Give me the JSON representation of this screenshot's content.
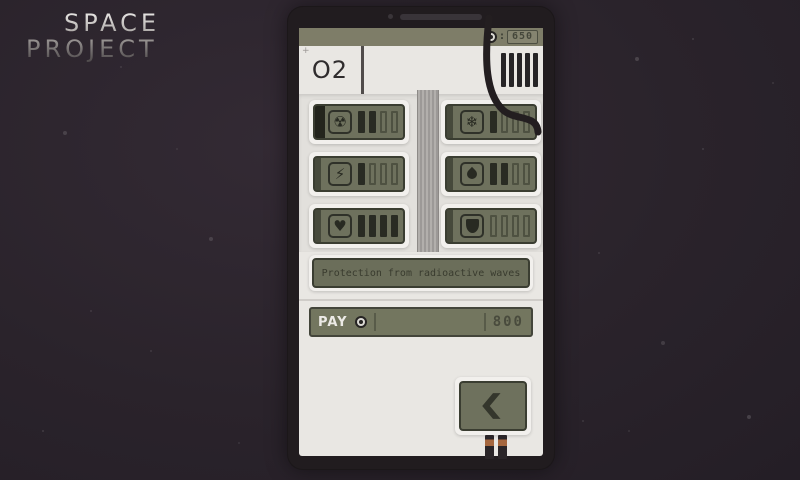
{
  "logo": {
    "line1": "SPACE",
    "line2": "PROJECT"
  },
  "palette": {
    "background": "#2a232b",
    "device_frame": "#211c1f",
    "screen": "#e9e7e3",
    "olive_panel": "#6e715d",
    "panel_border": "#3a3d31",
    "dark_ink": "#292b23",
    "copper_pin": "#a5673f"
  },
  "device": {
    "header": {
      "currency_icon": "gear-coin-icon",
      "separator": ":",
      "currency": "650"
    },
    "o2": {
      "plus": "+",
      "label": "O2",
      "gauge_bars": 5
    },
    "slots": [
      {
        "icon": "radiation-icon",
        "glyph": "☢",
        "bars_filled": 2,
        "bars_total": 4,
        "selected": true
      },
      {
        "icon": "snowflake-icon",
        "glyph": "❄",
        "bars_filled": 1,
        "bars_total": 4,
        "selected": false
      },
      {
        "icon": "lightning-icon",
        "glyph": "⚡",
        "bars_filled": 1,
        "bars_total": 4,
        "selected": false
      },
      {
        "icon": "flame-icon",
        "glyph": "",
        "shape": "flame",
        "bars_filled": 2,
        "bars_total": 4,
        "selected": false
      },
      {
        "icon": "heart-icon",
        "glyph": "♥",
        "bars_filled": 4,
        "bars_total": 4,
        "selected": false
      },
      {
        "icon": "shield-icon",
        "glyph": "",
        "shape": "shield",
        "bars_filled": 0,
        "bars_total": 4,
        "selected": false
      }
    ],
    "description": "Protection from radioactive waves",
    "pay": {
      "label": "PAY",
      "price": "800"
    }
  }
}
